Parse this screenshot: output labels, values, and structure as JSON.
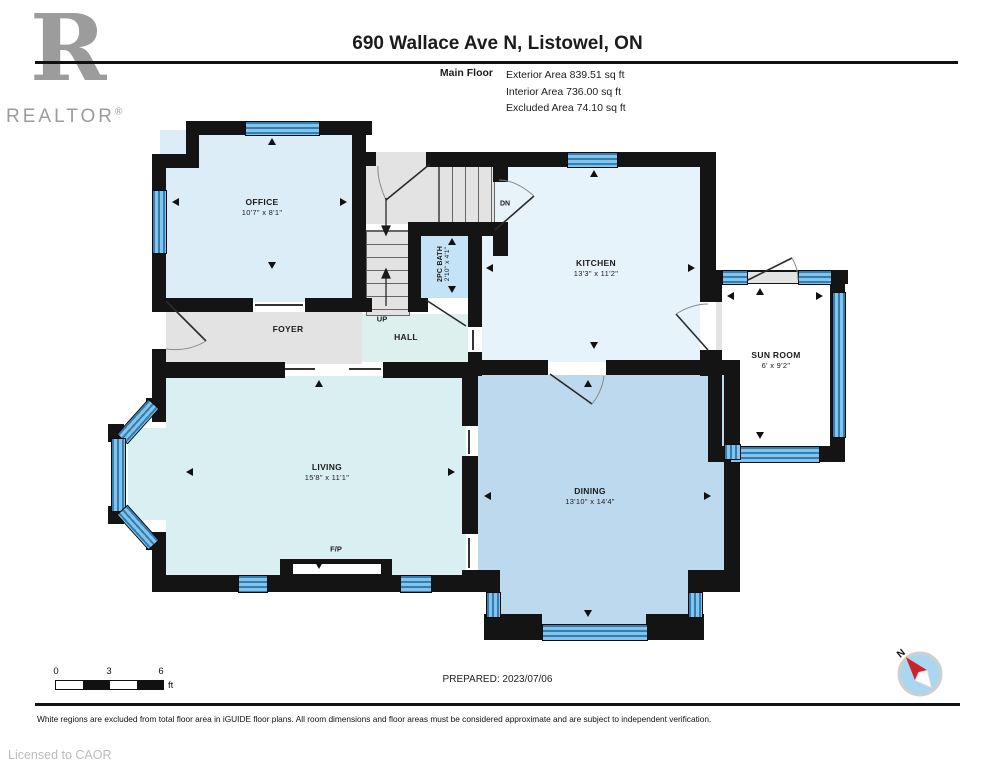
{
  "header": {
    "logo_initial": "R",
    "logo_label": "REALTOR",
    "logo_reg": "®",
    "title": "690 Wallace Ave N, Listowel, ON",
    "floor_label": "Main Floor",
    "stats": [
      "Exterior Area 839.51 sq ft",
      "Interior Area 736.00 sq ft",
      "Excluded Area 74.10 sq ft"
    ]
  },
  "rooms": {
    "office": {
      "name": "OFFICE",
      "dims": "10'7\" x 8'1\""
    },
    "kitchen": {
      "name": "KITCHEN",
      "dims": "13'3\" x 11'2\""
    },
    "bath": {
      "name": "2PC BATH",
      "dims": "2'10\" x 4'1\""
    },
    "foyer": {
      "name": "FOYER"
    },
    "hall": {
      "name": "HALL"
    },
    "stairs_up": "UP",
    "stairs_dn": "DN",
    "sunroom": {
      "name": "SUN ROOM",
      "dims": "6' x 9'2\""
    },
    "living": {
      "name": "LIVING",
      "dims": "15'8\" x 11'1\""
    },
    "dining": {
      "name": "DINING",
      "dims": "13'10\" x 14'4\""
    },
    "fireplace": "F/P"
  },
  "footer": {
    "scale_ticks": [
      "0",
      "3",
      "6"
    ],
    "scale_unit": "ft",
    "prepared": "PREPARED: 2023/07/06",
    "disclaimer": "White regions are excluded from total floor area in iGUIDE floor plans. All room dimensions and floor areas must be considered approximate and are subject to independent verification.",
    "license": "Licensed to CAOR",
    "compass_north": "N"
  },
  "colors": {
    "wall": "#141414",
    "window_dark": "#2f7fb5",
    "window_light": "#85c3e8",
    "office_fill": "#dcedf8",
    "kitchen_fill": "#e7f3fa",
    "bath_fill": "#c4e3f6",
    "hall_fill": "#def0ee",
    "gray_fill": "#e3e3e3",
    "living_fill": "#daeff1",
    "dining_fill": "#bdd9ed",
    "sunroom_fill": "#ffffff",
    "compass_face": "#a9d7f0",
    "compass_needle": "#cc2229",
    "text": "#1c1c1c",
    "muted": "#9c9c9c"
  }
}
